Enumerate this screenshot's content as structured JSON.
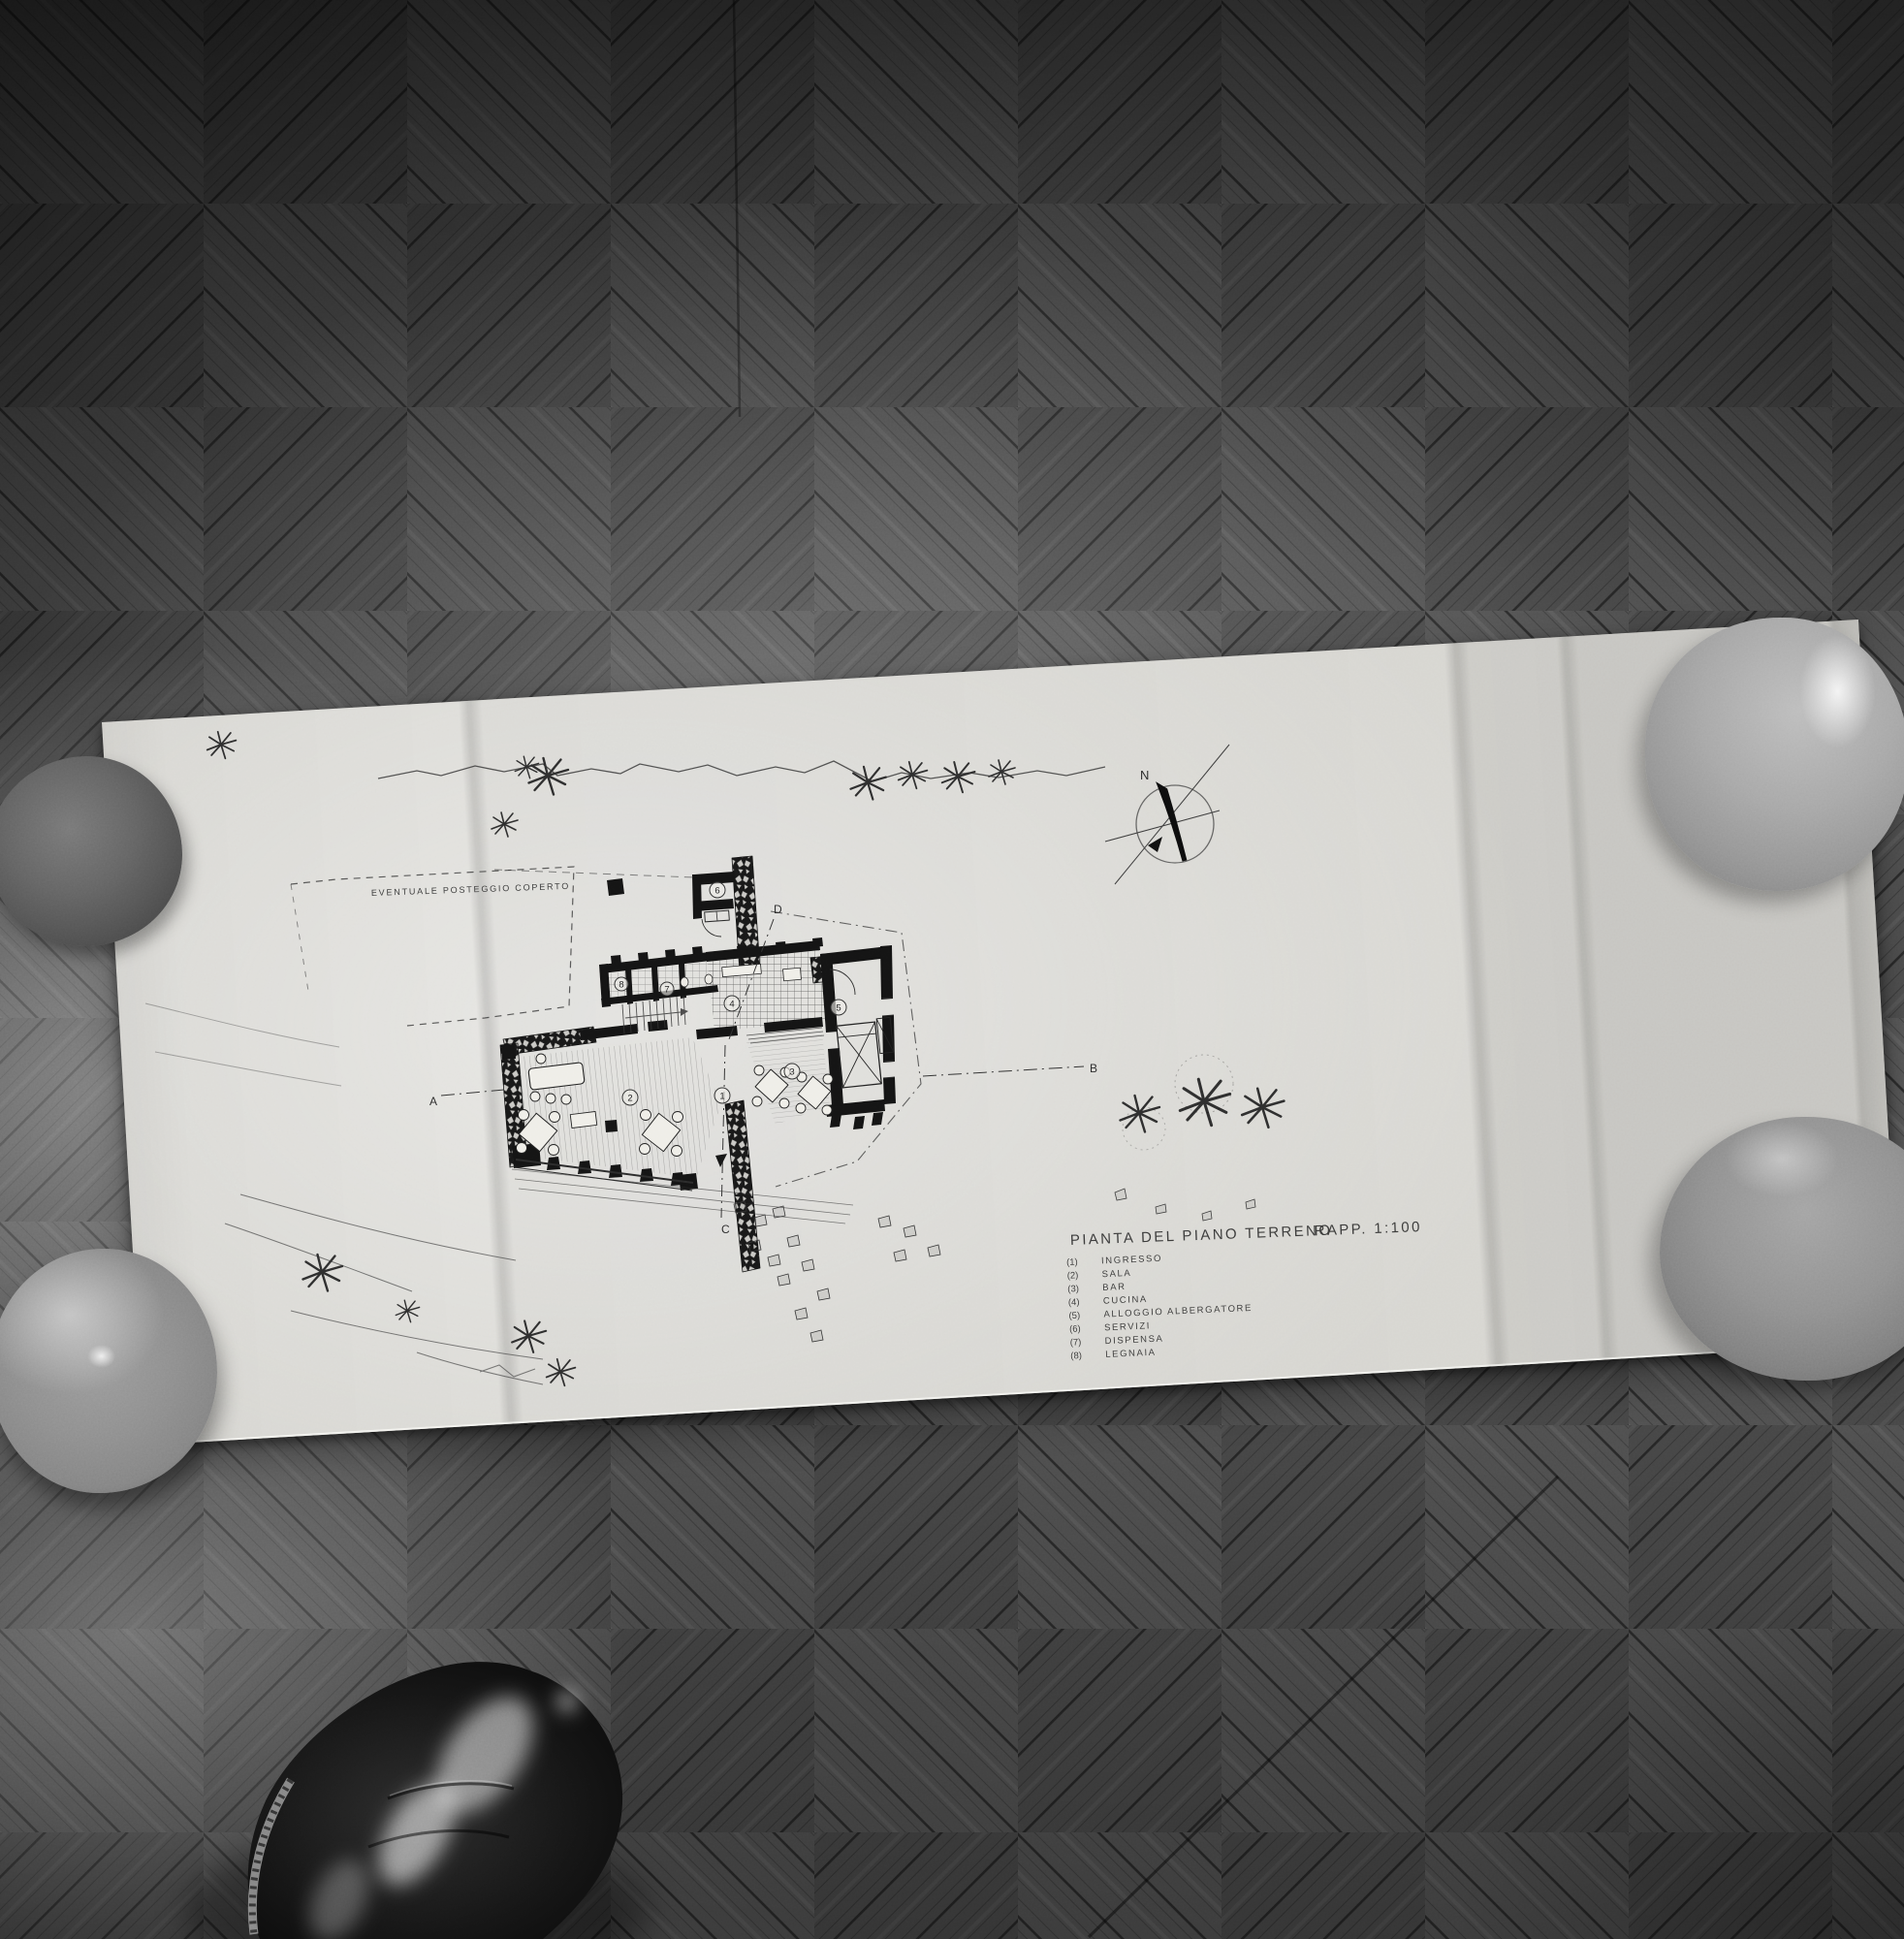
{
  "drawing": {
    "title": "PIANTA DEL PIANO TERRENO",
    "scale": "RAPP. 1:100",
    "note": "EVENTUALE POSTEGGIO COPERTO",
    "north": "N",
    "legend": [
      {
        "num": "(1)",
        "label": "INGRESSO"
      },
      {
        "num": "(2)",
        "label": "SALA"
      },
      {
        "num": "(3)",
        "label": "BAR"
      },
      {
        "num": "(4)",
        "label": "CUCINA"
      },
      {
        "num": "(5)",
        "label": "ALLOGGIO ALBERGATORE"
      },
      {
        "num": "(6)",
        "label": "SERVIZI"
      },
      {
        "num": "(7)",
        "label": "DISPENSA"
      },
      {
        "num": "(8)",
        "label": "LEGNAIA"
      }
    ],
    "rooms": [
      "1",
      "2",
      "3",
      "4",
      "5",
      "6",
      "7",
      "8"
    ],
    "sections": [
      "A",
      "B",
      "C",
      "D"
    ]
  },
  "colors": {
    "paper": "#d7d6d1",
    "ink": "#232323",
    "floor_plank": "#565656",
    "bowl_dark": "#5a5a5a",
    "bowl_light": "#a6a6a6",
    "shoe": "#0f0f0f"
  }
}
